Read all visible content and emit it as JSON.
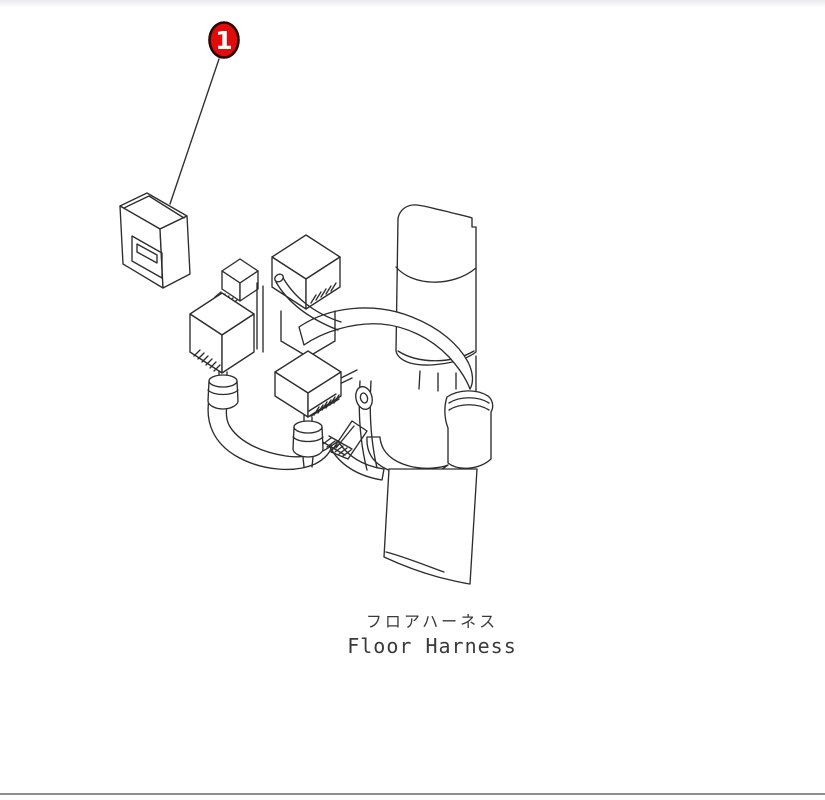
{
  "page": {
    "background_color": "#ffffff",
    "top_strip_color": "#ebebee",
    "bottom_line_color": "#8f8f8f"
  },
  "diagram": {
    "type": "isometric-parts-line-drawing",
    "line_color": "#2d2d2d",
    "caption_ja": "フロアハーネス",
    "caption_en": "Floor Harness",
    "callout": {
      "number": "1",
      "fill_color": "#e10b0b",
      "border_color": "#2a0000",
      "text_color": "#ffffff"
    }
  }
}
